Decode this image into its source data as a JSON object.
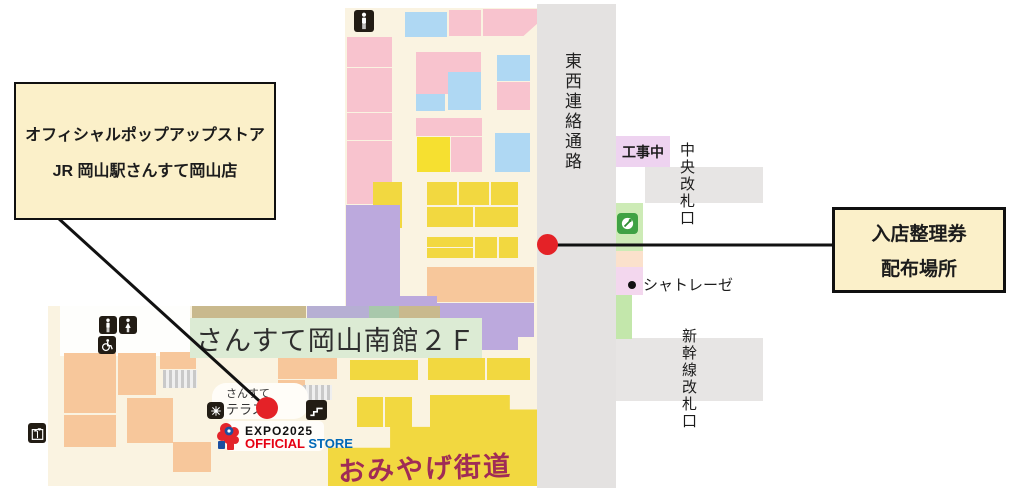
{
  "callouts": {
    "store": {
      "line1": "オフィシャルポップアップストア",
      "line2": "JR 岡山駅さんすて岡山店"
    },
    "ticket": {
      "line1": "入店整理券",
      "line2": "配布場所"
    }
  },
  "labels": {
    "corridor": "東西連絡通路",
    "construction": "工事中",
    "central_gate": "中央改札口",
    "chatraise": "シャトレーゼ",
    "shinkansen_gate": "新幹線改札口",
    "floor_banner": "さんすて岡山南館２Ｆ",
    "terrace_top": "さんすて",
    "terrace_bottom": "テラス",
    "omiyage": "おみやげ街道",
    "expo_title": "EXPO2025",
    "expo_official": "OFFICIAL",
    "expo_store": "STORE"
  },
  "colors": {
    "cream": "#faf3e1",
    "white": "#fefefc",
    "pink": "#f8c3ce",
    "blue": "#afd8f3",
    "yellow": "#f2d840",
    "bright_yellow": "#f6e030",
    "purple": "#bca9dd",
    "orange": "#f7c79b",
    "gray": "#e4e2e1",
    "band_gray": "#e7e5e4",
    "banner_green": "#dcebd4",
    "olive": "#c9b98d",
    "lavender": "#b6afd3",
    "sage": "#a8c8ab",
    "construction_pink": "#eed3f0",
    "strip_lightgreen": "#cdebb6",
    "strip_peach": "#fbe1cc",
    "strip_pinklav": "#f3d7ee",
    "strip_green": "#c3e7ab",
    "callout_bg": "#fbf0c9",
    "red_dot": "#e42227",
    "omiyage_text": "#a02c56",
    "expo_red": "#e60012",
    "expo_blue": "#0068b7"
  },
  "map": {
    "blocks": [
      {
        "x": 345,
        "y": 8,
        "w": 192,
        "h": 302,
        "c": "cream",
        "n": "upper-mall-floor"
      },
      {
        "x": 48,
        "y": 306,
        "w": 489,
        "h": 180,
        "c": "cream",
        "n": "lower-mall-floor"
      },
      {
        "x": 60,
        "y": 306,
        "w": 130,
        "h": 50,
        "c": "white",
        "n": "restroom-area"
      },
      {
        "x": 537,
        "y": 4,
        "w": 79,
        "h": 484,
        "c": "gray",
        "n": "east-west-corridor"
      },
      {
        "x": 645,
        "y": 167,
        "w": 118,
        "h": 36,
        "c": "band_gray",
        "n": "central-gate-area"
      },
      {
        "x": 616,
        "y": 338,
        "w": 147,
        "h": 63,
        "c": "band_gray",
        "n": "shinkansen-gate-area"
      },
      {
        "x": 616,
        "y": 136,
        "w": 54,
        "h": 31,
        "c": "construction_pink",
        "n": "construction-zone"
      },
      {
        "x": 616,
        "y": 203,
        "w": 27,
        "h": 48,
        "c": "strip_lightgreen",
        "n": "ticket-office-strip"
      },
      {
        "x": 616,
        "y": 251,
        "w": 27,
        "h": 16,
        "c": "strip_peach",
        "n": "shop-strip"
      },
      {
        "x": 616,
        "y": 267,
        "w": 27,
        "h": 28,
        "c": "strip_pinklav",
        "n": "chatraise-strip"
      },
      {
        "x": 616,
        "y": 295,
        "w": 16,
        "h": 44,
        "c": "strip_green",
        "n": "shop-strip"
      },
      {
        "x": 449,
        "y": 10,
        "w": 32,
        "h": 26,
        "c": "pink",
        "n": "tenant-block"
      },
      {
        "x": 483,
        "y": 9,
        "w": 54,
        "h": 27,
        "c": "pink",
        "n": "tenant-block",
        "clip": "polygon(0 0,100% 0,100% 55%,75% 100%,0 100%)"
      },
      {
        "x": 405,
        "y": 12,
        "w": 42,
        "h": 25,
        "c": "blue",
        "n": "tenant-block"
      },
      {
        "x": 347,
        "y": 37,
        "w": 45,
        "h": 30,
        "c": "pink",
        "n": "tenant-block"
      },
      {
        "x": 347,
        "y": 68,
        "w": 45,
        "h": 44,
        "c": "pink",
        "n": "tenant-block"
      },
      {
        "x": 347,
        "y": 113,
        "w": 45,
        "h": 27,
        "c": "pink",
        "n": "tenant-block"
      },
      {
        "x": 347,
        "y": 141,
        "w": 45,
        "h": 63,
        "c": "pink",
        "n": "tenant-block"
      },
      {
        "x": 416,
        "y": 52,
        "w": 65,
        "h": 42,
        "c": "pink",
        "n": "tenant-block"
      },
      {
        "x": 448,
        "y": 72,
        "w": 33,
        "h": 38,
        "c": "blue",
        "n": "tenant-block"
      },
      {
        "x": 416,
        "y": 94,
        "w": 29,
        "h": 17,
        "c": "blue",
        "n": "tenant-block"
      },
      {
        "x": 497,
        "y": 55,
        "w": 33,
        "h": 26,
        "c": "blue",
        "n": "tenant-block"
      },
      {
        "x": 497,
        "y": 82,
        "w": 33,
        "h": 28,
        "c": "pink",
        "n": "tenant-block"
      },
      {
        "x": 495,
        "y": 133,
        "w": 35,
        "h": 39,
        "c": "blue",
        "n": "tenant-block"
      },
      {
        "x": 416,
        "y": 118,
        "w": 66,
        "h": 18,
        "c": "pink",
        "n": "tenant-block"
      },
      {
        "x": 451,
        "y": 137,
        "w": 31,
        "h": 35,
        "c": "pink",
        "n": "tenant-block"
      },
      {
        "x": 417,
        "y": 137,
        "w": 33,
        "h": 35,
        "c": "bright_yellow",
        "n": "tenant-block"
      },
      {
        "x": 373,
        "y": 182,
        "w": 29,
        "h": 46,
        "c": "yellow",
        "n": "tenant-block"
      },
      {
        "x": 427,
        "y": 182,
        "w": 30,
        "h": 23,
        "c": "yellow",
        "n": "tenant-block"
      },
      {
        "x": 459,
        "y": 182,
        "w": 30,
        "h": 23,
        "c": "yellow",
        "n": "tenant-block"
      },
      {
        "x": 491,
        "y": 182,
        "w": 27,
        "h": 23,
        "c": "yellow",
        "n": "tenant-block"
      },
      {
        "x": 427,
        "y": 207,
        "w": 46,
        "h": 20,
        "c": "yellow",
        "n": "tenant-block"
      },
      {
        "x": 475,
        "y": 207,
        "w": 43,
        "h": 20,
        "c": "yellow",
        "n": "tenant-block"
      },
      {
        "x": 427,
        "y": 237,
        "w": 46,
        "h": 10,
        "c": "yellow",
        "n": "tenant-block"
      },
      {
        "x": 427,
        "y": 248,
        "w": 46,
        "h": 10,
        "c": "yellow",
        "n": "tenant-block"
      },
      {
        "x": 475,
        "y": 237,
        "w": 22,
        "h": 21,
        "c": "yellow",
        "n": "tenant-block"
      },
      {
        "x": 499,
        "y": 237,
        "w": 19,
        "h": 21,
        "c": "yellow",
        "n": "tenant-block"
      },
      {
        "x": 427,
        "y": 267,
        "w": 107,
        "h": 35,
        "c": "orange",
        "n": "tenant-block"
      },
      {
        "x": 346,
        "y": 205,
        "w": 54,
        "h": 91,
        "c": "purple",
        "n": "tenant-block"
      },
      {
        "x": 346,
        "y": 296,
        "w": 91,
        "h": 13,
        "c": "purple",
        "n": "tenant-block"
      },
      {
        "x": 427,
        "y": 303,
        "w": 53,
        "h": 26,
        "c": "purple",
        "n": "tenant-block"
      },
      {
        "x": 474,
        "y": 303,
        "w": 60,
        "h": 34,
        "c": "purple",
        "n": "tenant-block"
      },
      {
        "x": 474,
        "y": 337,
        "w": 44,
        "h": 13,
        "c": "purple",
        "n": "tenant-block"
      },
      {
        "x": 192,
        "y": 306,
        "w": 114,
        "h": 12,
        "c": "olive",
        "n": "tenant-block"
      },
      {
        "x": 307,
        "y": 306,
        "w": 62,
        "h": 12,
        "c": "lavender",
        "n": "tenant-block"
      },
      {
        "x": 369,
        "y": 306,
        "w": 30,
        "h": 12,
        "c": "sage",
        "n": "tenant-block"
      },
      {
        "x": 399,
        "y": 306,
        "w": 41,
        "h": 12,
        "c": "olive",
        "n": "tenant-block"
      },
      {
        "x": 64,
        "y": 353,
        "w": 52,
        "h": 60,
        "c": "orange",
        "n": "tenant-block"
      },
      {
        "x": 64,
        "y": 415,
        "w": 52,
        "h": 32,
        "c": "orange",
        "n": "tenant-block"
      },
      {
        "x": 118,
        "y": 353,
        "w": 38,
        "h": 42,
        "c": "orange",
        "n": "tenant-block"
      },
      {
        "x": 127,
        "y": 398,
        "w": 46,
        "h": 45,
        "c": "orange",
        "n": "tenant-block"
      },
      {
        "x": 173,
        "y": 442,
        "w": 38,
        "h": 30,
        "c": "orange",
        "n": "tenant-block"
      },
      {
        "x": 160,
        "y": 352,
        "w": 36,
        "h": 17,
        "c": "orange",
        "n": "tenant-block"
      },
      {
        "x": 278,
        "y": 352,
        "w": 59,
        "h": 27,
        "c": "orange",
        "n": "tenant-block"
      },
      {
        "x": 278,
        "y": 380,
        "w": 27,
        "h": 22,
        "c": "orange",
        "n": "tenant-block"
      },
      {
        "x": 350,
        "y": 360,
        "w": 68,
        "h": 20,
        "c": "yellow",
        "n": "tenant-block"
      },
      {
        "x": 428,
        "y": 358,
        "w": 57,
        "h": 22,
        "c": "yellow",
        "n": "tenant-block"
      },
      {
        "x": 487,
        "y": 358,
        "w": 43,
        "h": 22,
        "c": "yellow",
        "n": "tenant-block"
      },
      {
        "x": 357,
        "y": 397,
        "w": 26,
        "h": 30,
        "c": "yellow",
        "n": "tenant-block"
      },
      {
        "x": 385,
        "y": 397,
        "w": 27,
        "h": 30,
        "c": "yellow",
        "n": "tenant-block"
      },
      {
        "x": 432,
        "y": 397,
        "w": 25,
        "h": 28,
        "c": "yellow",
        "n": "tenant-block"
      },
      {
        "x": 328,
        "y": 395,
        "w": 209,
        "h": 91,
        "c": "yellow",
        "n": "omiyage-kaido-area",
        "clip": "polygon(0 58%,29.7% 58%,29.7% 35%,48.8% 35%,48.8% 0,87% 0,87% 16%,100% 16%,100% 100%,0 100%)"
      }
    ]
  }
}
